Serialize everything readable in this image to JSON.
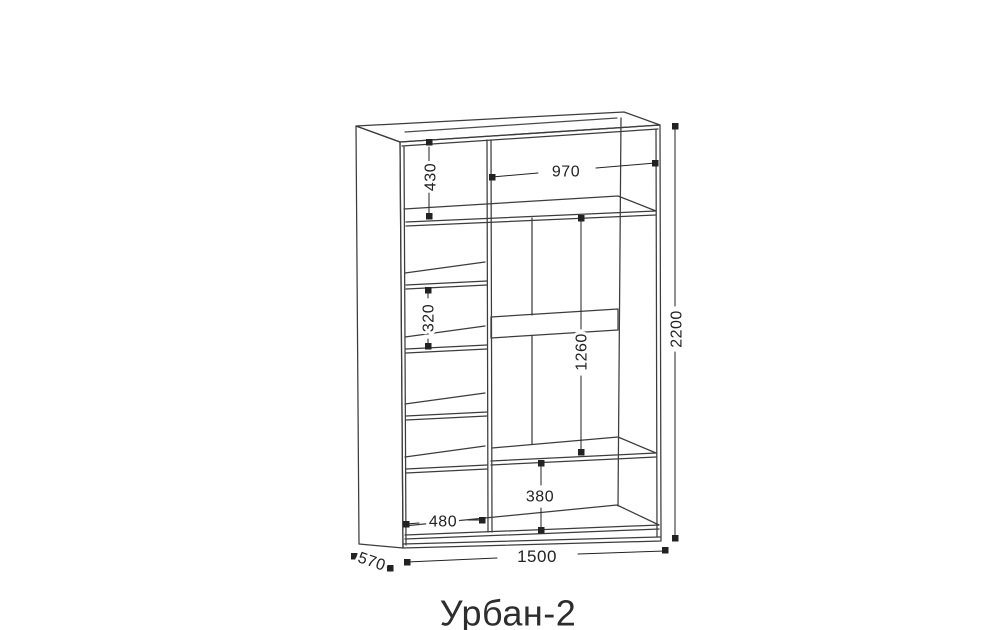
{
  "title": "Урбан-2",
  "drawing": {
    "background_color": "#ffffff",
    "line_color": "#3c3c3c",
    "dim_color": "#222222",
    "title_color": "#2d2d2d",
    "dimensions_mm": {
      "total_height": "2200",
      "total_width": "1500",
      "depth": "570",
      "top_left_compartment_height": "430",
      "top_right_compartment_width": "970",
      "left_column_shelf_spacing": "320",
      "middle_section_height": "1260",
      "bottom_compartment_height": "380",
      "left_column_width": "480"
    }
  }
}
